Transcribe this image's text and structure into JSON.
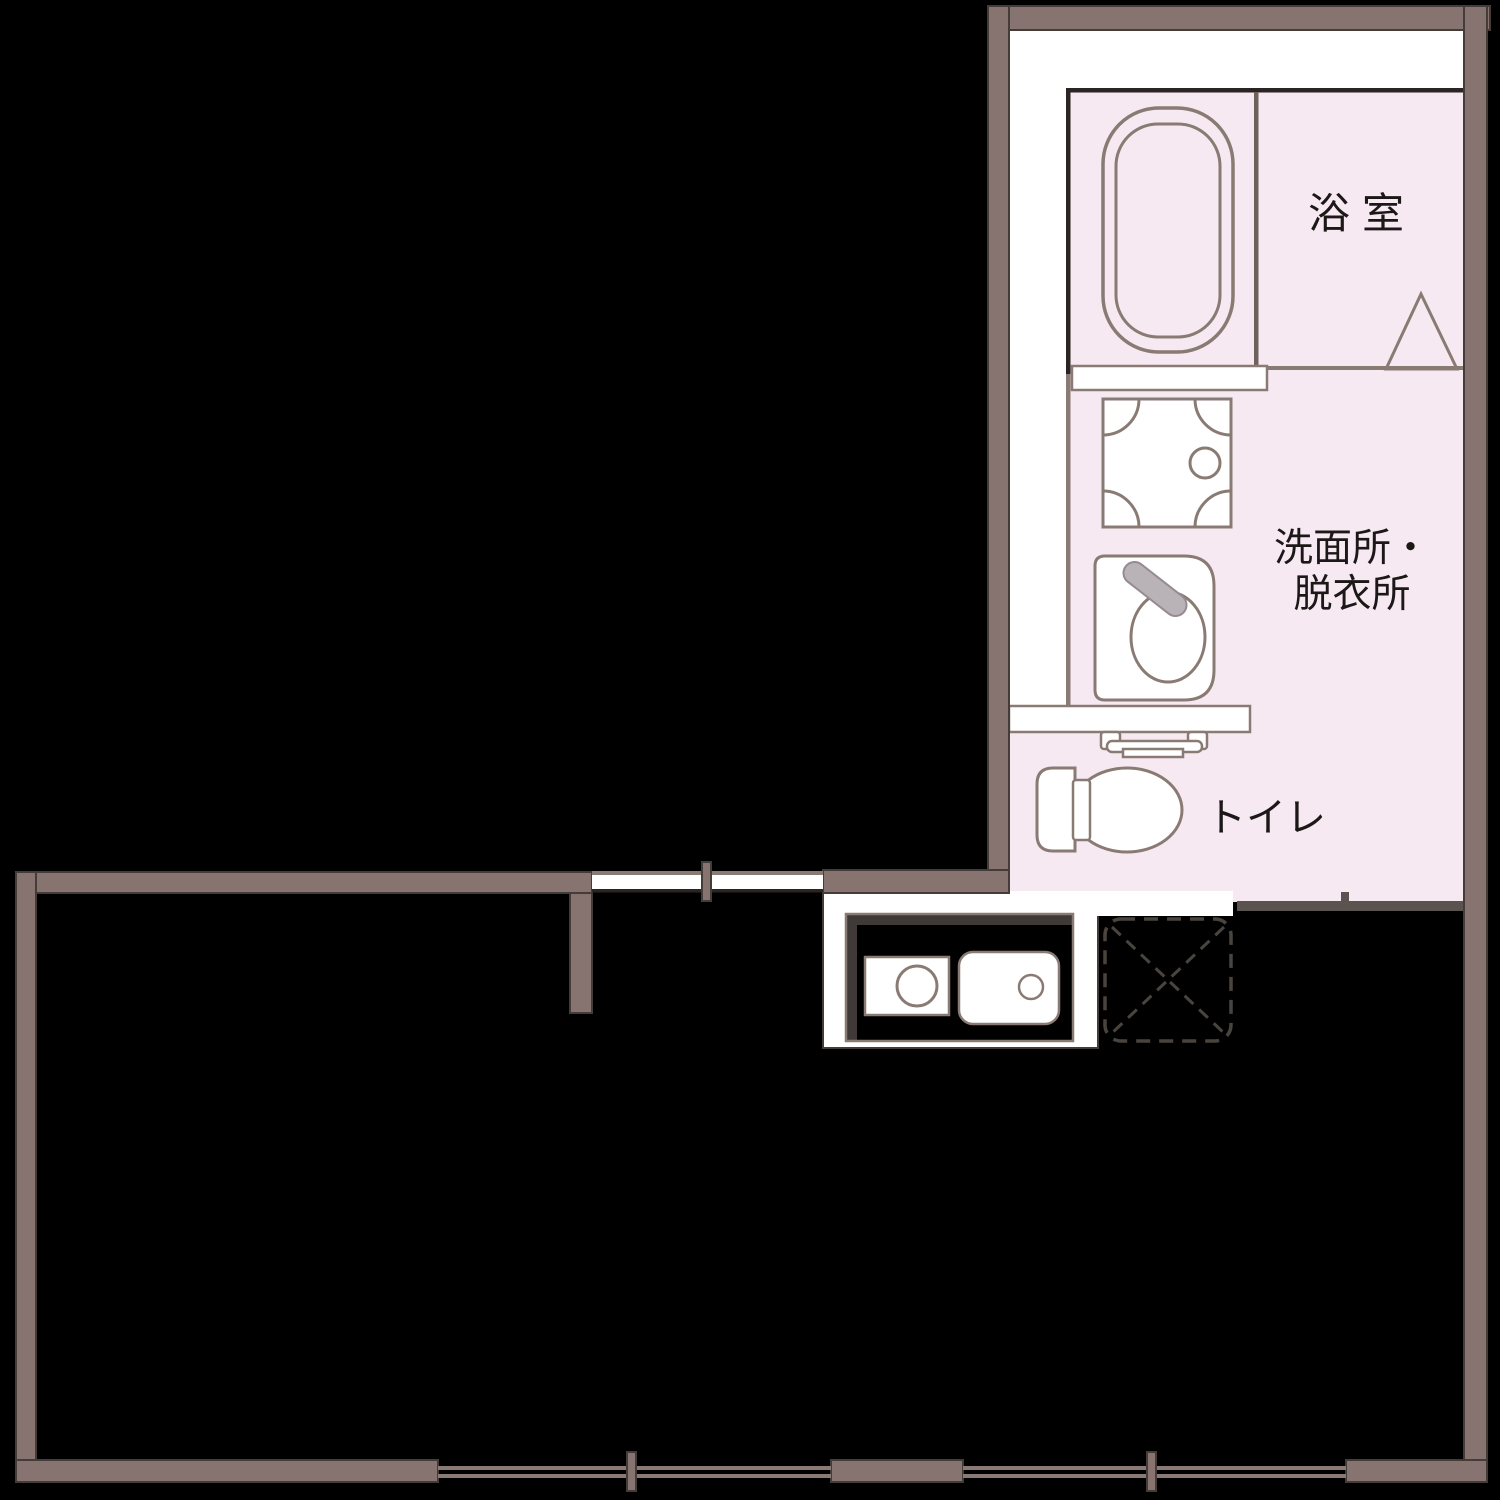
{
  "rooms": {
    "bath": {
      "label": "浴室"
    },
    "washroom": {
      "label_line1": "洗面所・",
      "label_line2": "脱衣所"
    },
    "toilet": {
      "label": "トイレ"
    }
  },
  "colors": {
    "bg": "#000000",
    "wall": "#877470",
    "wallEdge": "#433c39",
    "white": "#ffffff",
    "pink": "#f7e9f1",
    "line": "#8a7a74",
    "darkLine": "#2a2422",
    "divider": "#6f625d",
    "rail": "#5b534f",
    "innerShadow": "#3f3a37",
    "dash": "#4a443f",
    "faucet": "#b9b2b6",
    "faucetEdge": "#968b90",
    "text": "#1c1817"
  }
}
